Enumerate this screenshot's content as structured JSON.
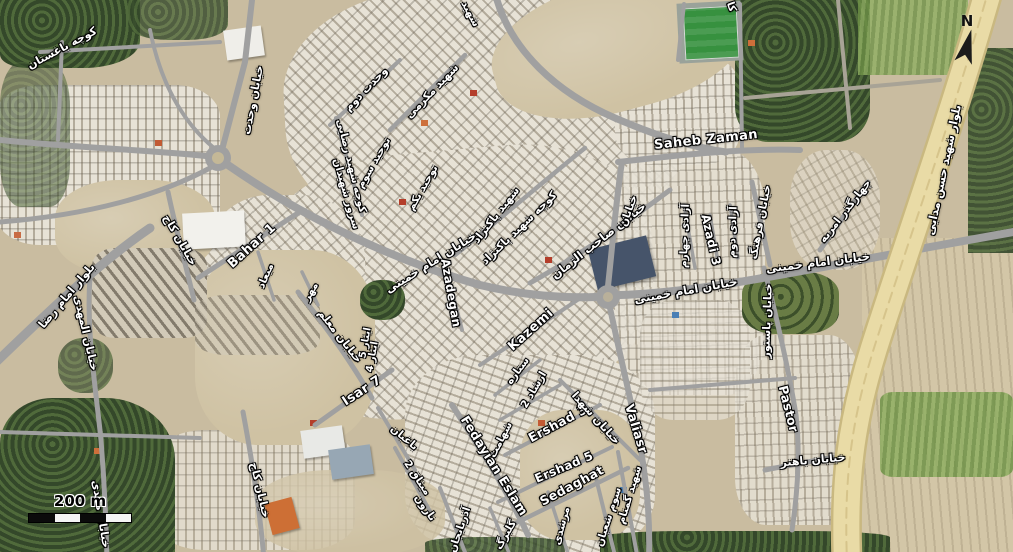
{
  "map": {
    "view": "satellite",
    "scale_bar": {
      "label": "200 m"
    },
    "north_indicator": {
      "label": "N"
    },
    "colors": {
      "desert": "#cfc2a3",
      "urban_light": "#e7e2d6",
      "road_gray": "#a0a0a0",
      "boulevard_yellow": "#e9dba6",
      "vegetation_green": "#425632",
      "stadium_green": "#37913f",
      "field_green": "#7c9a50",
      "label_text": "#ffffff",
      "label_outline": "#000000"
    },
    "street_labels": [
      {
        "text": "کوچه باغستان",
        "x": 62,
        "y": 48,
        "rot": -28,
        "size": 11
      },
      {
        "text": "خیابان وحدت",
        "x": 253,
        "y": 100,
        "rot": -79,
        "size": 11
      },
      {
        "text": "وحدت دوم",
        "x": 366,
        "y": 89,
        "rot": -46,
        "size": 11
      },
      {
        "text": "شهید مکرمی",
        "x": 432,
        "y": 91,
        "rot": -46,
        "size": 11
      },
      {
        "text": "کوچه شهید رضایی",
        "x": 351,
        "y": 166,
        "rot": 76,
        "size": 10.5
      },
      {
        "text": "سرور شهیدان",
        "x": 346,
        "y": 194,
        "rot": 74,
        "size": 10.5
      },
      {
        "text": "توحید سوم",
        "x": 374,
        "y": 163,
        "rot": -60,
        "size": 10.5
      },
      {
        "text": "توحید یکم",
        "x": 423,
        "y": 188,
        "rot": -60,
        "size": 10.5
      },
      {
        "text": "شهید پاکنژاد",
        "x": 496,
        "y": 215,
        "rot": -52,
        "size": 11
      },
      {
        "text": "کوچه شهید پاکنژاد",
        "x": 519,
        "y": 228,
        "rot": -44,
        "size": 11
      },
      {
        "text": "خیابان صاحب الزمان",
        "x": 599,
        "y": 241,
        "rot": -38,
        "size": 11.5
      },
      {
        "text": "خیابان امام خمینی",
        "x": 431,
        "y": 263,
        "rot": -32,
        "size": 11.5
      },
      {
        "text": "خیابان امام خمینی",
        "x": 686,
        "y": 291,
        "rot": -10,
        "size": 11.5
      },
      {
        "text": "خیابان امام خمینی",
        "x": 818,
        "y": 263,
        "rot": -7,
        "size": 11.5
      },
      {
        "text": "Saheb Zaman",
        "x": 706,
        "y": 140,
        "rot": -6,
        "size": 13,
        "latin": true
      },
      {
        "text": "Bahar 1",
        "x": 252,
        "y": 246,
        "rot": -42,
        "size": 13,
        "latin": true
      },
      {
        "text": "Azadegan",
        "x": 451,
        "y": 293,
        "rot": 80,
        "size": 12,
        "latin": true
      },
      {
        "text": "Kazemi",
        "x": 531,
        "y": 330,
        "rot": -42,
        "size": 13,
        "latin": true
      },
      {
        "text": "Isar 7",
        "x": 362,
        "y": 391,
        "rot": -33,
        "size": 13,
        "latin": true
      },
      {
        "text": "Ershad 3",
        "x": 558,
        "y": 424,
        "rot": -28,
        "size": 12.5,
        "latin": true
      },
      {
        "text": "Fedayian Eslam",
        "x": 494,
        "y": 466,
        "rot": 58,
        "size": 12.5,
        "latin": true
      },
      {
        "text": "Ershad 5",
        "x": 564,
        "y": 467,
        "rot": -23,
        "size": 12,
        "latin": true
      },
      {
        "text": "Sedaghat",
        "x": 572,
        "y": 486,
        "rot": -28,
        "size": 12.5,
        "latin": true
      },
      {
        "text": "Valiasr",
        "x": 636,
        "y": 429,
        "rot": 73,
        "size": 12.5,
        "latin": true
      },
      {
        "text": "Pastor",
        "x": 788,
        "y": 409,
        "rot": 76,
        "size": 12.5,
        "latin": true
      },
      {
        "text": "Azadi 3",
        "x": 711,
        "y": 240,
        "rot": 77,
        "size": 12,
        "latin": true
      },
      {
        "text": "آزادی دوم",
        "x": 733,
        "y": 232,
        "rot": -88,
        "size": 10.5
      },
      {
        "text": "آزادی چهارم",
        "x": 685,
        "y": 236,
        "rot": -88,
        "size": 10.5
      },
      {
        "text": "خیابان",
        "x": 629,
        "y": 211,
        "rot": -70,
        "size": 10.5
      },
      {
        "text": "خیابان فرهنگ",
        "x": 760,
        "y": 222,
        "rot": -79,
        "size": 11
      },
      {
        "text": "چهارگذر امریه",
        "x": 845,
        "y": 211,
        "rot": -52,
        "size": 11
      },
      {
        "text": "خیابان پاستور",
        "x": 767,
        "y": 321,
        "rot": -88,
        "size": 11
      },
      {
        "text": "بلوار شهید حسن مدایی",
        "x": 944,
        "y": 170,
        "rot": -78,
        "size": 11.5
      },
      {
        "text": "خیابان کاج",
        "x": 180,
        "y": 240,
        "rot": 60,
        "size": 11
      },
      {
        "text": "میعاد",
        "x": 266,
        "y": 276,
        "rot": -67,
        "size": 10.5
      },
      {
        "text": "مهر",
        "x": 311,
        "y": 292,
        "rot": -60,
        "size": 10.5
      },
      {
        "text": "خیابان معلم",
        "x": 340,
        "y": 336,
        "rot": 52,
        "size": 11
      },
      {
        "text": "ایثار 5",
        "x": 366,
        "y": 343,
        "rot": -80,
        "size": 10
      },
      {
        "text": "ایثار 4",
        "x": 373,
        "y": 357,
        "rot": -80,
        "size": 10
      },
      {
        "text": "بلوار امام رضا",
        "x": 67,
        "y": 296,
        "rot": -50,
        "size": 11.5
      },
      {
        "text": "خیابان المهدی",
        "x": 86,
        "y": 333,
        "rot": 77,
        "size": 11
      },
      {
        "text": "خیابان مهدی",
        "x": 101,
        "y": 514,
        "rot": 81,
        "size": 11
      },
      {
        "text": "باغبان",
        "x": 404,
        "y": 438,
        "rot": 40,
        "size": 10.5
      },
      {
        "text": "میثاق 2",
        "x": 417,
        "y": 478,
        "rot": 56,
        "size": 10.5
      },
      {
        "text": "نارون",
        "x": 425,
        "y": 508,
        "rot": 55,
        "size": 10.5
      },
      {
        "text": "خیابان کاج",
        "x": 260,
        "y": 490,
        "rot": 77,
        "size": 11
      },
      {
        "text": "آذربایجان",
        "x": 460,
        "y": 530,
        "rot": -71,
        "size": 10.5
      },
      {
        "text": "ستاره",
        "x": 518,
        "y": 371,
        "rot": -53,
        "size": 10.5
      },
      {
        "text": "ارشاد 2",
        "x": 534,
        "y": 390,
        "rot": -60,
        "size": 10.5
      },
      {
        "text": "شهامت",
        "x": 501,
        "y": 440,
        "rot": -63,
        "size": 10.5
      },
      {
        "text": "گلبرگ",
        "x": 506,
        "y": 535,
        "rot": -60,
        "size": 10.5
      },
      {
        "text": "مرشدی",
        "x": 562,
        "y": 526,
        "rot": -75,
        "size": 10.5
      },
      {
        "text": "سوم شعبان",
        "x": 609,
        "y": 517,
        "rot": -72,
        "size": 10.5
      },
      {
        "text": "شهید گمنام",
        "x": 630,
        "y": 495,
        "rot": -73,
        "size": 10.5
      },
      {
        "text": "خیابان شهدا",
        "x": 596,
        "y": 418,
        "rot": 48,
        "size": 11
      },
      {
        "text": "خیابان باهنر",
        "x": 813,
        "y": 460,
        "rot": -5,
        "size": 11
      },
      {
        "text": "شهید",
        "x": 470,
        "y": 14,
        "rot": 62,
        "size": 10.5
      },
      {
        "text": "کا",
        "x": 731,
        "y": 7,
        "rot": 70,
        "size": 10.5
      }
    ]
  }
}
